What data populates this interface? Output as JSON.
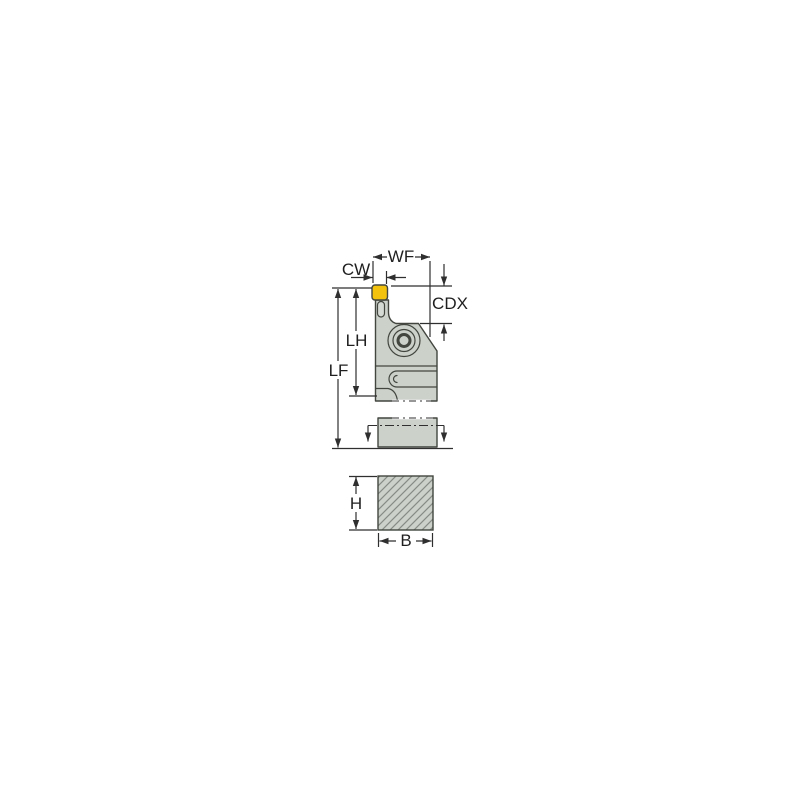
{
  "drawing": {
    "dimension_labels": {
      "wf": "WF",
      "cw": "CW",
      "cdx": "CDX",
      "lh": "LH",
      "lf": "LF",
      "h": "H",
      "b": "B"
    }
  },
  "colors": {
    "background": "#ffffff",
    "body_fill": "#ccd1ca",
    "capsule_fill": "#d6dad4",
    "insert_fill": "#f2c20d",
    "outline": "#42463f",
    "dimension_line": "#2f2f2f",
    "hatch_line": "#868c85",
    "label_text": "#1f1f1f"
  }
}
